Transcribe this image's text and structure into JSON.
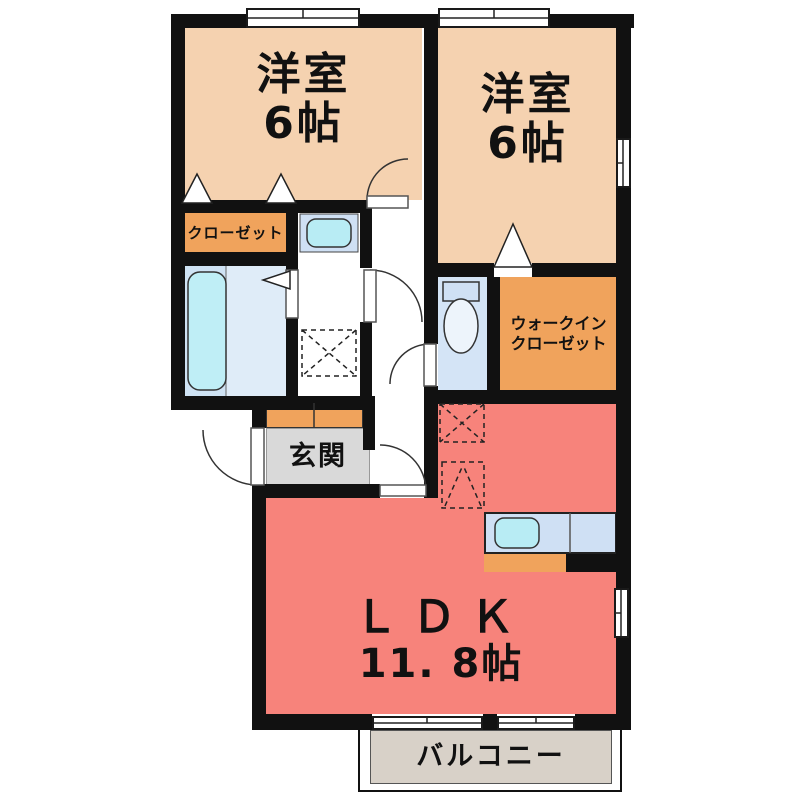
{
  "rooms": {
    "bedroom1": {
      "name": "洋室",
      "size": "6帖"
    },
    "bedroom2": {
      "name": "洋室",
      "size": "6帖"
    },
    "ldk": {
      "name": "ＬＤＫ",
      "size": "11. 8帖"
    },
    "entrance": {
      "label": "玄関"
    },
    "closet": {
      "label": "クローゼット"
    },
    "walk_in_closet": {
      "label_line1": "ウォークイン",
      "label_line2": "クローゼット"
    },
    "balcony": {
      "label": "バルコニー"
    }
  },
  "colors": {
    "bedroom_fill": "#f5d2b0",
    "closet_fill": "#f0a35c",
    "ldk_fill": "#f7837b",
    "entrance_floor": "#d9d9d9",
    "balcony_fill": "#d8d1c8",
    "bath_floor": "#dcebf7",
    "bathtub_fill": "#bfeef6",
    "sanitary_blue": "#cfe0f4",
    "wall": "#111111"
  },
  "fixtures": {
    "bathtub": "bathtub-icon",
    "washbasin": "washbasin-icon",
    "washing_machine_space": "washing-machine-space-icon",
    "toilet": "toilet-icon",
    "kitchen_sink": "kitchen-sink-icon",
    "refrigerator_space": "refrigerator-space-icon",
    "door_swings": "door-arc-icon",
    "folding_door_marks": "door-triangle-icon"
  }
}
